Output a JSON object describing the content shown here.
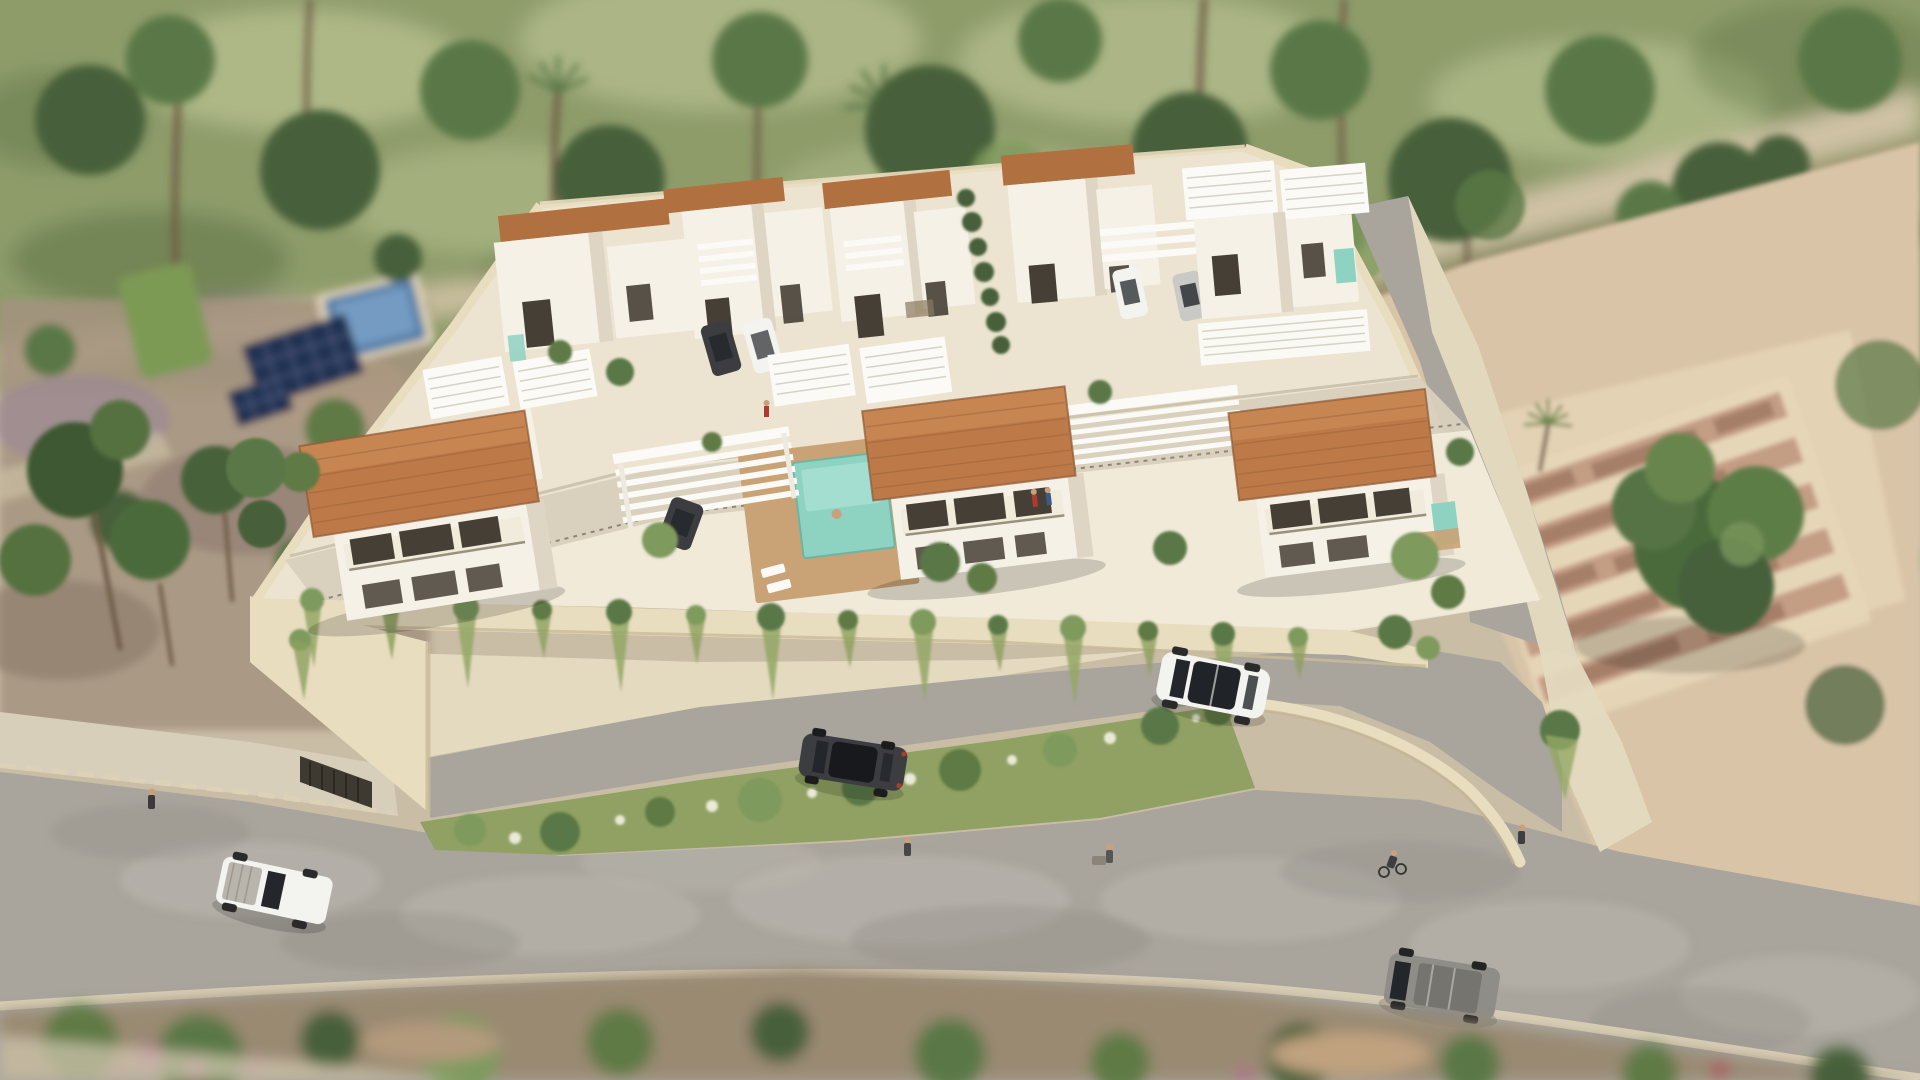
{
  "scene": {
    "type": "3d-aerial-architectural-render",
    "description": "Aerial daytime 3D rendering of a gated residential development of white modern villas with terracotta roofs, white pergolas, private pools and a cream perimeter wall with hanging plants, surrounded by green fields, dirt lots with ruins, and gray roads with cars, cyclists and pedestrians.",
    "time_of_day": "day",
    "text_content": ""
  },
  "palette": {
    "ground_tan": "#c9bda6",
    "field_green": "#8e9c6b",
    "field_light": "#b8c190",
    "field_dark": "#5f7547",
    "tree_dark": "#46613a",
    "tree_mid": "#5a7846",
    "tree_light": "#7e9a5d",
    "trunk_brown": "#6e5c47",
    "path_beige": "#cfc2a4",
    "dirt_red": "#a97f6a",
    "sand": "#d9c4a7",
    "sand_light": "#e6d6b8",
    "ruin_wall": "#c49d85",
    "ruin_dark": "#9c7660",
    "wall_cream": "#e9ddc0",
    "wall_shade": "#d5c7a8",
    "apron_beige": "#e4dac0",
    "compound_ground": "#ece4d0",
    "paving_light": "#f1ead9",
    "drive_gray": "#d8d0bd",
    "villa_white": "#f5f1e7",
    "villa_shade": "#ded5c4",
    "roof_terracotta": "#bd7a48",
    "roof_ridge": "#cd8c58",
    "roof_cap_brown": "#b0703f",
    "roof_line": "#96603a",
    "pergola_white": "#fbfaf6",
    "pergola_line": "#d7d2c6",
    "window_dark": "#463f36",
    "pool_teal": "#8ed2c2",
    "pool_teal_light": "#aae1d4",
    "pool_blue": "#557fa9",
    "pool_blue_light": "#7ca3c8",
    "deck_tan": "#c9a375",
    "solar_panel": "#243252",
    "road_gray": "#a9a59d",
    "road_light": "#bcb8b0",
    "road_dark": "#8f8b84",
    "kerb_light": "#ddd2b8",
    "sidewalk": "#d8cfbb",
    "median_green": "#90a163",
    "flower_white": "#e9ead8",
    "bottom_dirt": "#9a8a72",
    "veg_green": "#5e7a45",
    "flower_pink": "#b06a8a",
    "car_white": "#f3f3f0",
    "car_dark": "#3c3d41",
    "car_gray": "#8f8d88",
    "car_silver": "#c9c9c6",
    "car_glass": "#23272b",
    "skin_tone": "#caa07c"
  },
  "objects": {
    "development": {
      "front_villas_terracotta_roof": 3,
      "back_row_villa_clusters": 5,
      "white_pergola_structures": 5,
      "central_pool": "teal pool with wooden deck and sun loungers",
      "small_private_pools": 3,
      "perimeter_wall": "cream stucco wall with cascading hanging plants",
      "solar_panels_neighbor_plot": 1,
      "neighbor_blue_pool": 1,
      "ruins_lot": "brick foundation walls on sandy lot, east side"
    },
    "vehicles": [
      {
        "name": "white-suv",
        "color": "white",
        "location": "access road along front wall"
      },
      {
        "name": "dark-sedan",
        "color": "dark gray",
        "location": "access road near entrance gate"
      },
      {
        "name": "white-pickup",
        "color": "white",
        "location": "main road lower left"
      },
      {
        "name": "gray-van",
        "color": "gray",
        "location": "main road lower right"
      },
      {
        "name": "parked-dark-car",
        "color": "dark gray",
        "location": "driveway back row"
      },
      {
        "name": "parked-white-car",
        "color": "white",
        "location": "driveway back row"
      },
      {
        "name": "parked-white-car-2",
        "color": "white",
        "location": "driveway upper right"
      },
      {
        "name": "parked-silver-car",
        "color": "silver",
        "location": "driveway upper right"
      },
      {
        "name": "carport-dark-car",
        "color": "dark gray",
        "location": "under left pergola"
      }
    ],
    "people": [
      {
        "name": "pedestrian-left",
        "location": "main road left"
      },
      {
        "name": "pedestrian-center",
        "location": "main road center"
      },
      {
        "name": "person-with-cart",
        "location": "main road center right"
      },
      {
        "name": "cyclist",
        "location": "main road right"
      },
      {
        "name": "pedestrian-right",
        "location": "main road far right"
      },
      {
        "name": "balcony-residents",
        "location": "center villa balcony"
      },
      {
        "name": "walker-in-compound",
        "location": "interior drive"
      }
    ],
    "roads": {
      "main_road": "wide gray asphalt sweeping across the bottom",
      "access_road": "gray lane between perimeter wall and curved outer wall",
      "median": "planted strip with shrubs and white flowers",
      "paths": "beige dirt paths through fields top left and top right"
    },
    "landscape": {
      "top": "blurred green fields with rows of trees and tall palm trunks",
      "left": "neighbor plot with lawn, blue pool and solar panels",
      "right": "sandy lot with ruin walls, small palm and a large green tree",
      "bottom": "blurred shrubs, dirt and pink flowering bushes"
    }
  }
}
